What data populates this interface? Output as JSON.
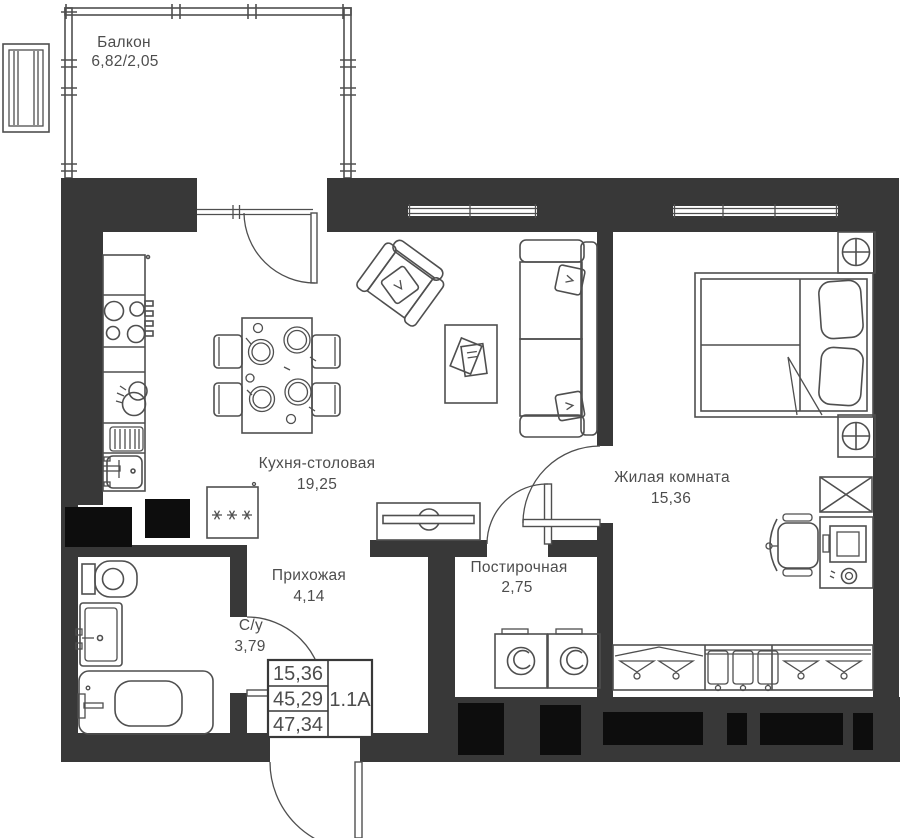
{
  "plan": {
    "rooms": {
      "balcony": {
        "name": "Балкон",
        "area": "6,82/2,05"
      },
      "kitchen": {
        "name": "Кухня-столовая",
        "area": "19,25"
      },
      "living": {
        "name": "Жилая комната",
        "area": "15,36"
      },
      "hall": {
        "name": "Прихожая",
        "area": "4,14"
      },
      "laundry": {
        "name": "Постирочная",
        "area": "2,75"
      },
      "bath": {
        "name": "С/у",
        "area": "3,79"
      }
    },
    "info": {
      "living_area": "15,36",
      "area_no_balcony": "45,29",
      "total_area": "47,34",
      "unit_code": "1.1А"
    }
  },
  "colors": {
    "wall": "#383838",
    "line": "#4f4f4f",
    "text": "#4d4d4d",
    "vent": "#0d0d0d",
    "bg": "#ffffff"
  }
}
